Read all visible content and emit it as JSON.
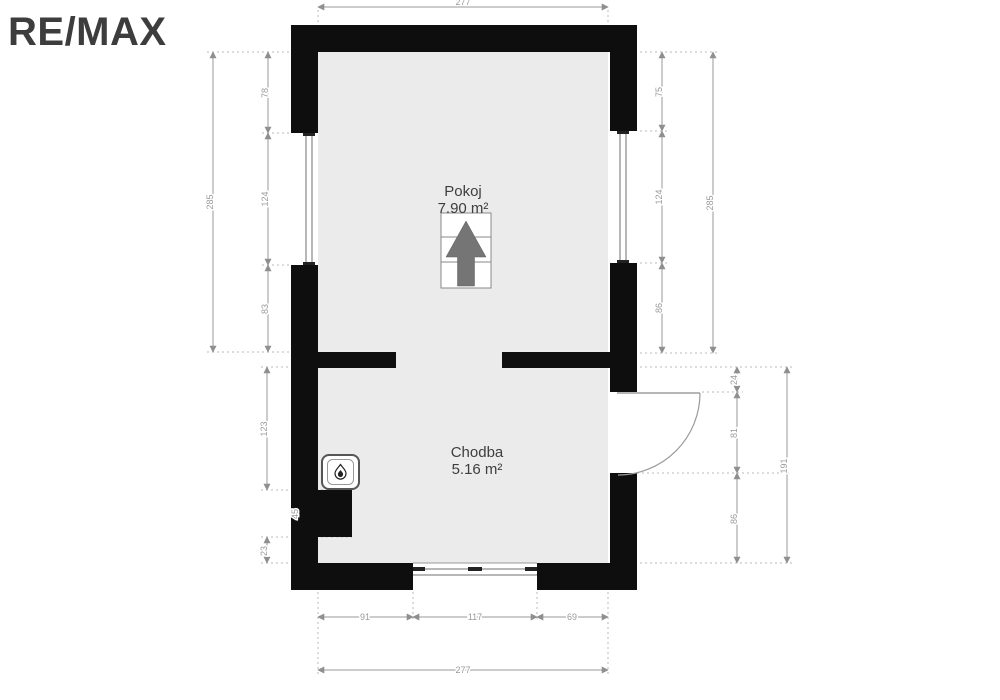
{
  "brand": {
    "logo_text": "RE/MAX"
  },
  "rooms": {
    "pokoj": {
      "name": "Pokoj",
      "area": "7.90 m²"
    },
    "chodba": {
      "name": "Chodba",
      "area": "5.16 m²"
    }
  },
  "dimensions": {
    "top_total": "277",
    "upper_left": {
      "outer": "285",
      "segments": [
        "78",
        "124",
        "83"
      ]
    },
    "upper_right": {
      "outer": "285",
      "segments": [
        "75",
        "124",
        "86"
      ]
    },
    "lower_left": {
      "segments": [
        "123",
        "45",
        "23"
      ]
    },
    "lower_right": {
      "outer": "191",
      "segments": [
        "24",
        "81",
        "86"
      ]
    },
    "bottom": {
      "total": "277",
      "segments": [
        "91",
        "117",
        "69"
      ]
    }
  },
  "icons": {
    "north_arrow": "north-arrow",
    "boiler": "gas-flame"
  },
  "colors": {
    "wall": "#0e0e0e",
    "floor": "#ebebeb",
    "dimension": "#9a9a9a",
    "label_text": "#3e3e3e",
    "logo": "#3d3d3d",
    "north_arrow_fill": "#757575"
  }
}
